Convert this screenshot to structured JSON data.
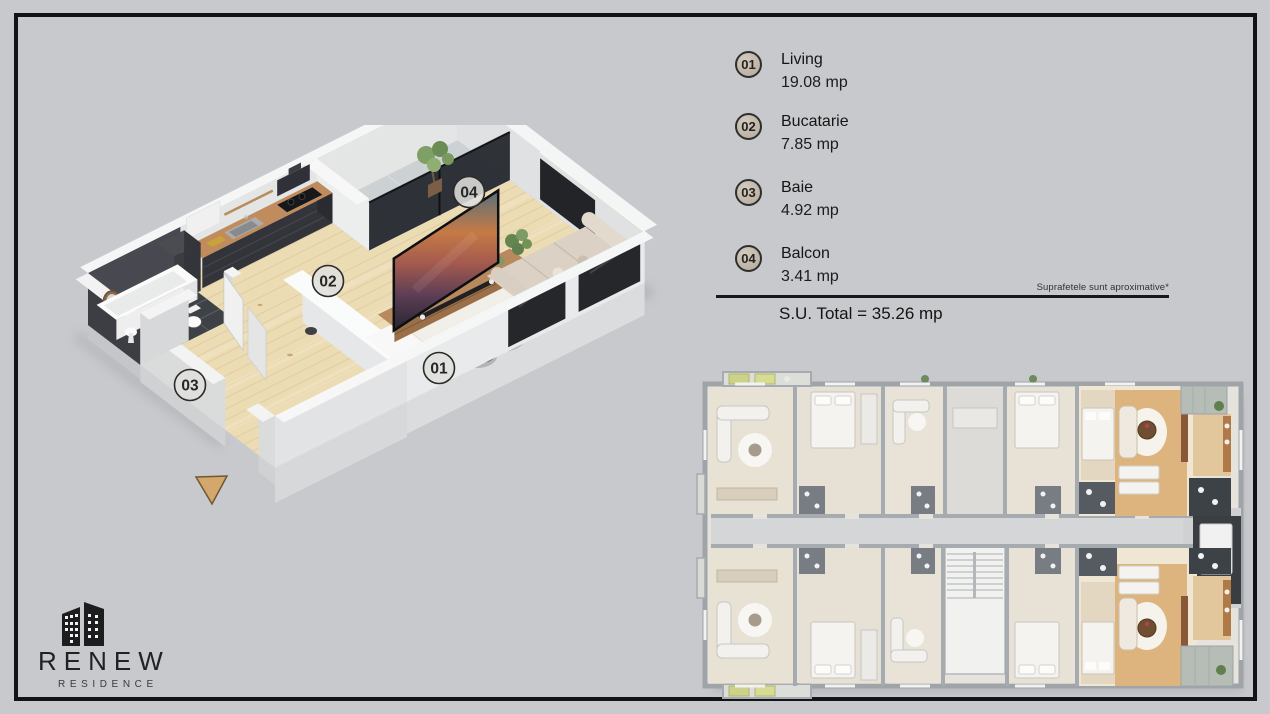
{
  "colors": {
    "background": "#c8c9cc",
    "frame": "#131316",
    "legend_badge_fill": "#c0b7a9",
    "entrance_arrow": "#d4a76c",
    "highlight_wood": "#ddb47e",
    "render_wood": "#ecdcb4"
  },
  "legend": {
    "items": [
      {
        "number": "01",
        "name": "Living",
        "area": "19.08 mp"
      },
      {
        "number": "02",
        "name": "Bucatarie",
        "area": "7.85 mp"
      },
      {
        "number": "03",
        "name": "Baie",
        "area": "4.92 mp"
      },
      {
        "number": "04",
        "name": "Balcon",
        "area": "3.41 mp"
      }
    ],
    "note": "Suprafetele sunt aproximative*",
    "total": "S.U. Total = 35.26 mp"
  },
  "render": {
    "badges": [
      {
        "label": "01"
      },
      {
        "label": "02"
      },
      {
        "label": "03"
      },
      {
        "label": "04"
      }
    ]
  },
  "logo": {
    "title": "RENEW",
    "subtitle": "RESIDENCE"
  }
}
